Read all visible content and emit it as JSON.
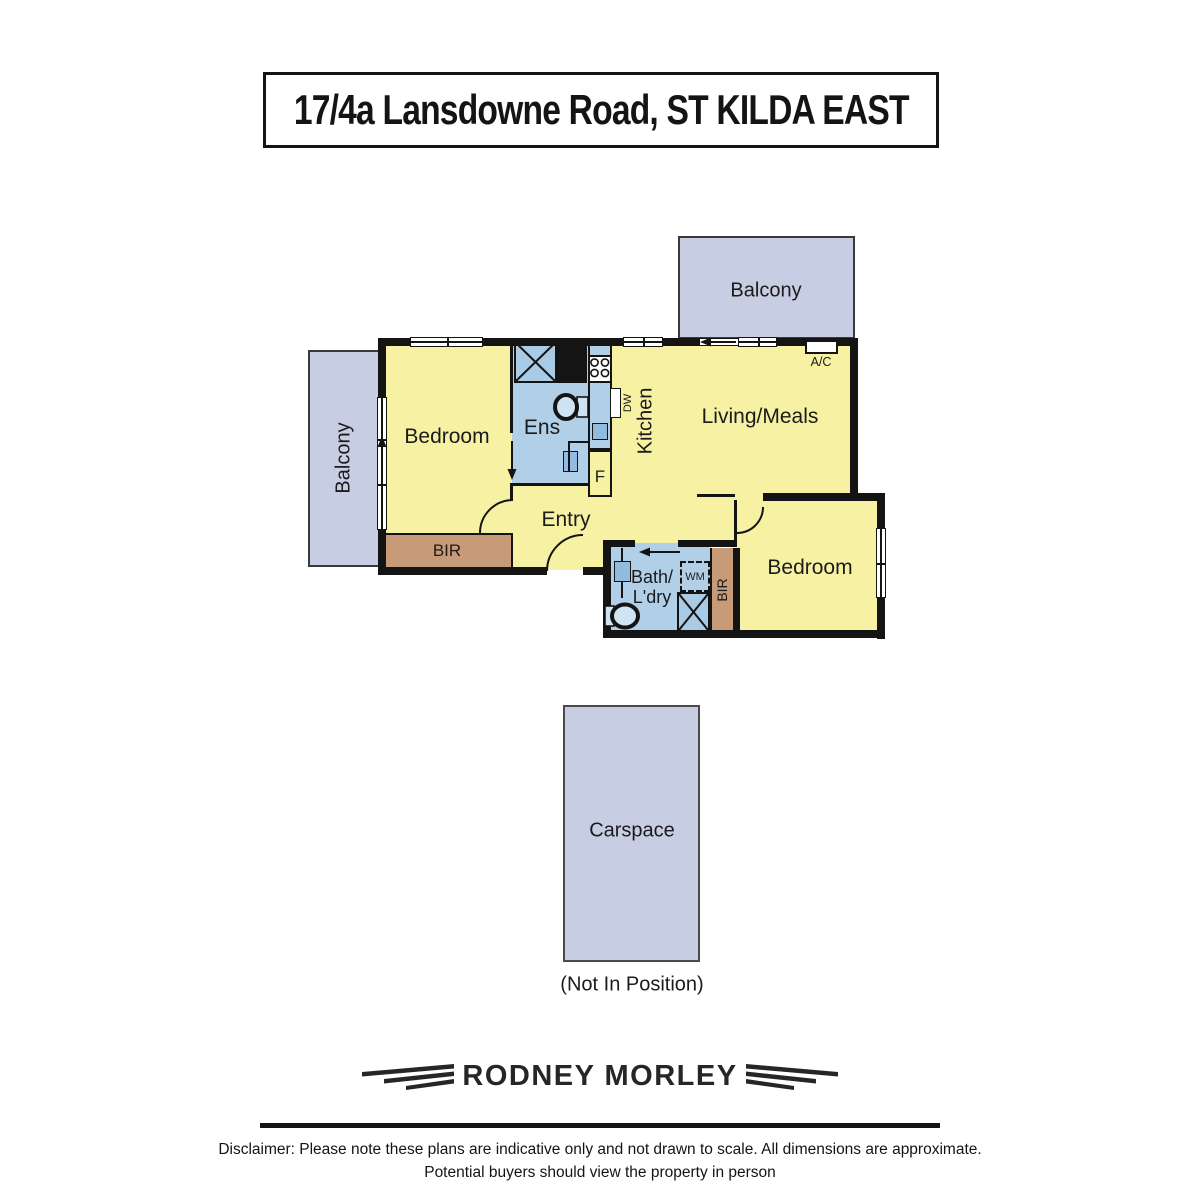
{
  "title": "17/4a Lansdowne Road, ST KILDA EAST",
  "plan": {
    "balcony_top_label": "Balcony",
    "balcony_left_label": "Balcony",
    "bedroom_main_label": "Bedroom",
    "ensuite_label": "Ens",
    "kitchen_label": "Kitchen",
    "dishwasher_label": "DW",
    "fridge_label": "F",
    "living_label": "Living/Meals",
    "aircon_label": "A/C",
    "entry_label": "Entry",
    "bir_main_label": "BIR",
    "bath_label_line1": "Bath/",
    "bath_label_line2": "L'dry",
    "washing_machine_label": "WM",
    "bir_second_label": "BIR",
    "bedroom_second_label": "Bedroom"
  },
  "carspace": {
    "label": "Carspace",
    "note": "(Not In Position)"
  },
  "brand": {
    "name": "RODNEY MORLEY"
  },
  "disclaimer": {
    "line1": "Disclaimer: Please note these plans are indicative only and not drawn to scale. All dimensions are approximate.",
    "line2": "Potential buyers should view the property in person"
  },
  "colors": {
    "room_yellow": "#F6F1A3",
    "balcony_lavender": "#C7CDE2",
    "wet_blue": "#B2CFE8",
    "fixture_blue": "#93BBDF",
    "shower_blue": "#A9CBE6",
    "wardrobe_brown": "#C79A78",
    "wall_black": "#141414"
  }
}
